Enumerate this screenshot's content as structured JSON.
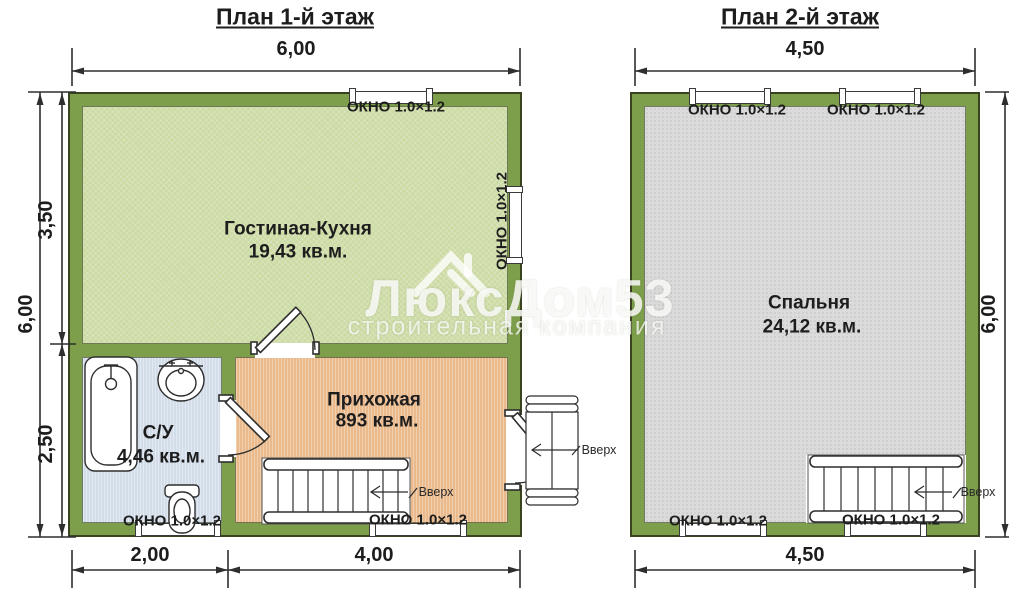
{
  "labels": {
    "window": "ОКНО 1.0×1.2",
    "up": "Вверх"
  },
  "plan1": {
    "title": "План 1-й этаж",
    "dims": {
      "top": "6,00",
      "left": "6,00",
      "left_upper": "3,50",
      "left_lower": "2,50",
      "bottom_left": "2,00",
      "bottom_right": "4,00"
    },
    "rooms": {
      "living": {
        "name": "Гостиная-Кухня",
        "area": "19,43 кв.м."
      },
      "bathroom": {
        "name": "С/У",
        "area": "4,46 кв.м."
      },
      "hallway": {
        "name": "Прихожая",
        "area": "893 кв.м."
      }
    }
  },
  "plan2": {
    "title": "План 2-й этаж",
    "dims": {
      "top": "4,50",
      "right": "6,00",
      "bottom": "4,50"
    },
    "rooms": {
      "bedroom": {
        "name": "Спальня",
        "area": "24,12 кв.м."
      }
    }
  },
  "watermark": {
    "brand": "ЛюксДом53",
    "subtitle": "строительная компания"
  },
  "colors": {
    "wall": "#7d9e4a",
    "living": "#ccdaa4",
    "bathroom": "#d2dde9",
    "hallway": "#eaba8d",
    "bedroom": "#dbdbdb"
  }
}
